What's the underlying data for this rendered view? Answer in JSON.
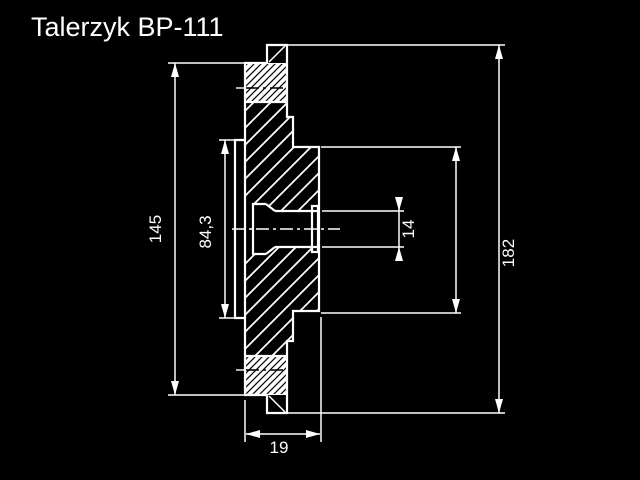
{
  "page": {
    "background_color": "#000000",
    "line_color": "#ffffff"
  },
  "title": {
    "text": "Talerzyk BP-111"
  },
  "drawing": {
    "kind": "technical cross-section of flanged disc",
    "units_implied": "mm",
    "dimensions": {
      "flange_diameter": {
        "label": "145",
        "orientation": "vertical"
      },
      "step_diameter": {
        "label": "84,3",
        "orientation": "vertical"
      },
      "bore_diameter": {
        "label": "14",
        "orientation": "vertical"
      },
      "outer_diameter": {
        "label": "182",
        "orientation": "vertical"
      },
      "hub_width": {
        "label": "19",
        "orientation": "horizontal"
      }
    }
  }
}
